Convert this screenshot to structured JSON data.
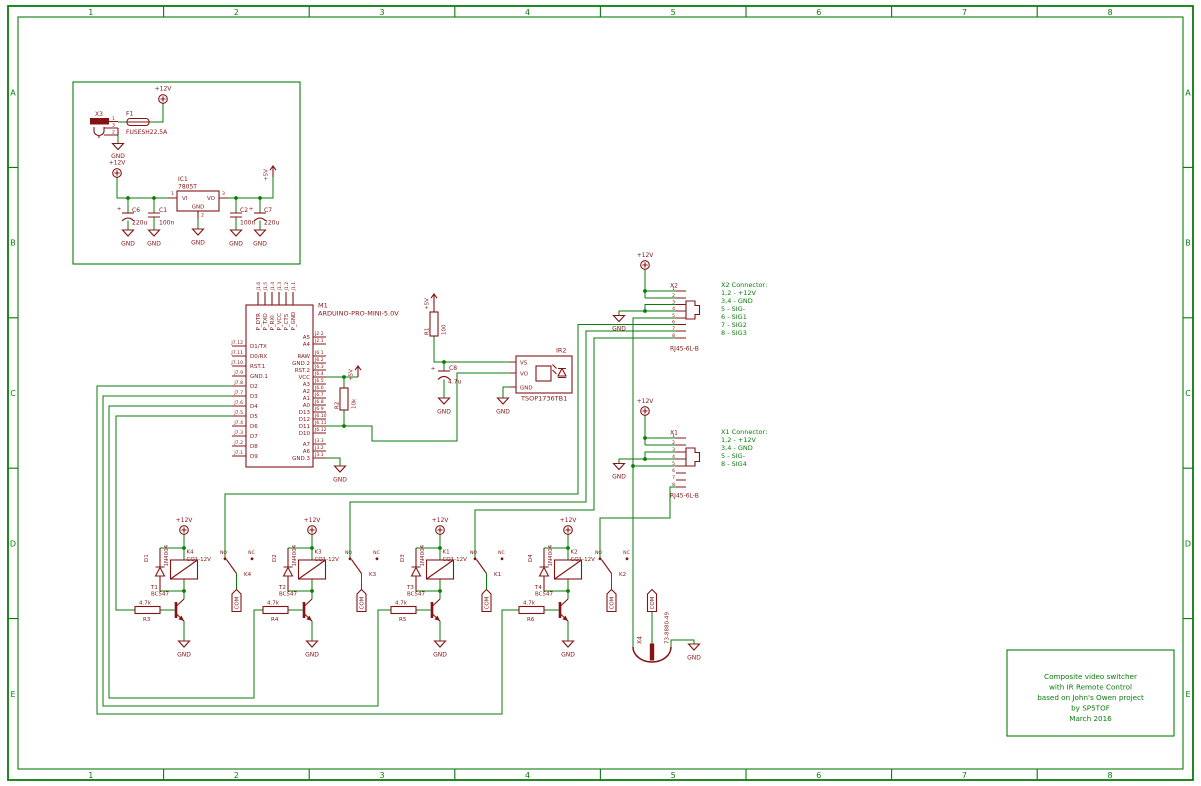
{
  "nets": {
    "gnd": "GND",
    "p12": "+12V",
    "p5": "+5V",
    "com": "COM",
    "no": "NO",
    "nc": "NC"
  },
  "vals": {
    "c220": "220u",
    "c100": "100n",
    "plus": "+"
  },
  "frame": {
    "cols": [
      "1",
      "2",
      "3",
      "4",
      "5",
      "6",
      "7",
      "8"
    ],
    "rows": [
      "A",
      "B",
      "C",
      "D",
      "E"
    ]
  },
  "title_block": {
    "line1": "Composite video switcher",
    "line2": "with IR Remote Control",
    "line3": "based on John's Owen project",
    "line4": "by SP5TOF",
    "line5": "March 2016"
  },
  "psu": {
    "x3": {
      "ref": "X3",
      "p1": "1",
      "p3": "3",
      "p2": "2"
    },
    "f1": {
      "ref": "F1",
      "value": "FUSESH22,5A"
    },
    "ic1": {
      "ref": "IC1",
      "value": "7805T",
      "vi": "VI",
      "vo": "VO",
      "gnd": "GND",
      "p1": "1",
      "p2": "2",
      "p3": "3"
    },
    "c6": {
      "ref": "C6"
    },
    "c1": {
      "ref": "C1"
    },
    "c2": {
      "ref": "C2"
    },
    "c7": {
      "ref": "C7"
    }
  },
  "arduino": {
    "ref": "M1",
    "value": "ARDUINO-PRO-MINI-5.0V",
    "left": [
      {
        "pin": "J7.12",
        "name": "D1/TX"
      },
      {
        "pin": "J7.11",
        "name": "D0/RX"
      },
      {
        "pin": "J7.10",
        "name": "RST.1"
      },
      {
        "pin": "J7.9",
        "name": "GND.1"
      },
      {
        "pin": "J7.8",
        "name": "D2"
      },
      {
        "pin": "J7.7",
        "name": "D3"
      },
      {
        "pin": "J7.6",
        "name": "D4"
      },
      {
        "pin": "J7.5",
        "name": "D5"
      },
      {
        "pin": "J7.4",
        "name": "D6"
      },
      {
        "pin": "J7.3",
        "name": "D7"
      },
      {
        "pin": "J7.2",
        "name": "D8"
      },
      {
        "pin": "J7.1",
        "name": "D9"
      }
    ],
    "j2": [
      {
        "pin": "J2.2",
        "name": "A5"
      },
      {
        "pin": "J2.1",
        "name": "A4"
      }
    ],
    "j6": [
      {
        "pin": "J6.1",
        "name": "RAW"
      },
      {
        "pin": "J6.2",
        "name": "GND.2"
      },
      {
        "pin": "J6.3",
        "name": "RST.2"
      },
      {
        "pin": "J6.4",
        "name": "VCC"
      },
      {
        "pin": "J6.5",
        "name": "A3"
      },
      {
        "pin": "J6.6",
        "name": "A2"
      },
      {
        "pin": "J6.7",
        "name": "A1"
      },
      {
        "pin": "J6.8",
        "name": "A0"
      },
      {
        "pin": "J6.9",
        "name": "D13"
      },
      {
        "pin": "J6.10",
        "name": "D12"
      },
      {
        "pin": "J6.11",
        "name": "D11"
      },
      {
        "pin": "J6.12",
        "name": "D10"
      }
    ],
    "j3": [
      {
        "pin": "J3.3",
        "name": "A7"
      },
      {
        "pin": "J3.2",
        "name": "A6"
      },
      {
        "pin": "J3.1",
        "name": "GND.3"
      }
    ],
    "top": [
      {
        "pin": "J1.6",
        "name": "P_DTR"
      },
      {
        "pin": "J1.5",
        "name": "P_TXO"
      },
      {
        "pin": "J1.4",
        "name": "P_RXI"
      },
      {
        "pin": "J1.3",
        "name": "P_VCC"
      },
      {
        "pin": "J1.2",
        "name": "P_CTS"
      },
      {
        "pin": "J1.1",
        "name": "P_GND"
      }
    ]
  },
  "r2": {
    "ref": "R2",
    "value": "10k"
  },
  "ir": {
    "r1": {
      "ref": "R1",
      "value": "100"
    },
    "c8": {
      "ref": "C8",
      "value": "4.7u"
    },
    "ic": {
      "ref": "IR2",
      "value": "TSOP1736TB1",
      "vs": "VS",
      "vo": "VO",
      "gnd": "GND"
    }
  },
  "connectors": {
    "pins": [
      "1",
      "2",
      "3",
      "4",
      "5",
      "6",
      "7",
      "8"
    ],
    "x2": {
      "ref": "X2",
      "value": "RJ45-6L-B",
      "note": [
        "X2 Connector:",
        "1,2 - +12V",
        "3,4 - GND",
        "5 - SIG-",
        "6 - SIG1",
        "7 - SIG2",
        "8 - SIG3"
      ]
    },
    "x1": {
      "ref": "X1",
      "value": "RJ45-6L-B",
      "note": [
        "X1 Connector:",
        "1,2 - +12V",
        "3,4 - GND",
        "5 - SIG-",
        "8 - SIG4"
      ]
    },
    "x4": {
      "ref": "X4",
      "value": "73-8880-49"
    }
  },
  "relays": [
    {
      "d": "D1",
      "dv": "1N4004",
      "k": "K4",
      "kv": "CQ1-12V",
      "t": "T1",
      "tv": "BC547",
      "r": "R3",
      "rv": "4.7k",
      "kc": "K4"
    },
    {
      "d": "D2",
      "dv": "1N4004",
      "k": "K3",
      "kv": "CQ1-12V",
      "t": "T2",
      "tv": "BC547",
      "r": "R4",
      "rv": "4.7k",
      "kc": "K3"
    },
    {
      "d": "D3",
      "dv": "1N4004",
      "k": "K1",
      "kv": "CQ1-12V",
      "t": "T3",
      "tv": "BC547",
      "r": "R5",
      "rv": "4.7k",
      "kc": "K1"
    },
    {
      "d": "D4",
      "dv": "1N4004",
      "k": "K2",
      "kv": "CQ1-12V",
      "t": "T4",
      "tv": "BC547",
      "r": "R6",
      "rv": "4.7k",
      "kc": "K2"
    }
  ]
}
